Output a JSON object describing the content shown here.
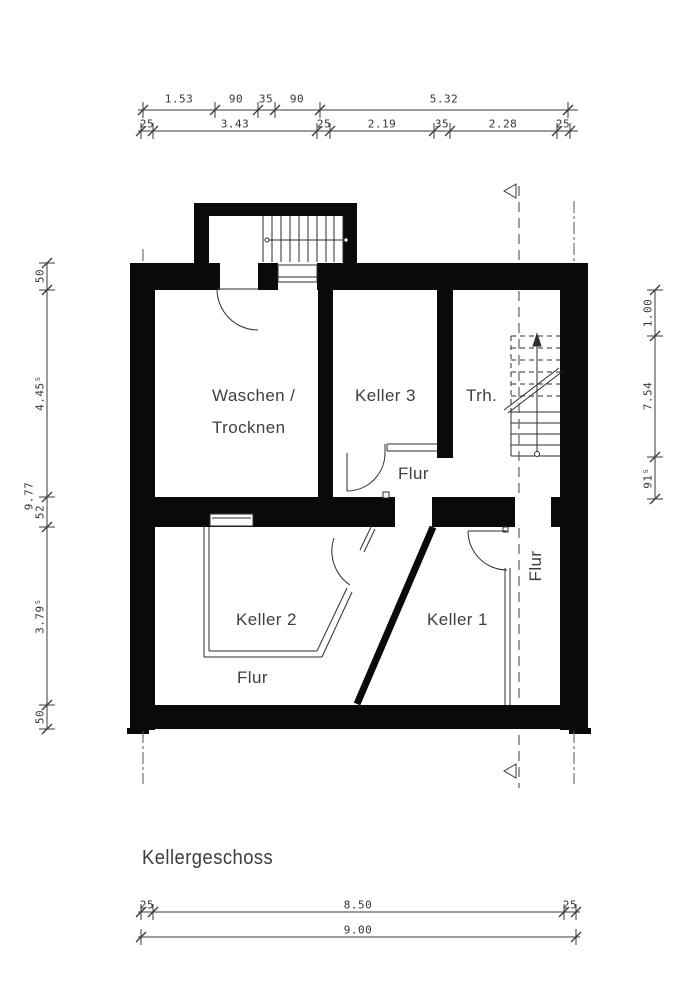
{
  "title": "Kellergeschoss",
  "rooms": {
    "waschen_line1": "Waschen /",
    "waschen_line2": "Trocknen",
    "keller3": "Keller 3",
    "trh": "Trh.",
    "flur_upper": "Flur",
    "keller2": "Keller 2",
    "keller1": "Keller 1",
    "flur_lower": "Flur",
    "flur_right": "Flur"
  },
  "dimensions": {
    "top_upper": [
      "1.53",
      "90",
      "35",
      "90",
      "5.32"
    ],
    "top_lower": [
      "25",
      "3.43",
      "25",
      "2.19",
      "35",
      "2.28",
      "25"
    ],
    "left_segments": [
      "50",
      "4.45⁵",
      "52",
      "3.79⁵",
      "50"
    ],
    "left_total": "9.77",
    "right_segments": [
      "1.00",
      "7.54",
      "91⁵"
    ],
    "bottom_segments": [
      "25",
      "8.50",
      "25"
    ],
    "bottom_total": "9.00"
  },
  "colors": {
    "wall": "#0a0a0a",
    "line": "#2e2e2e",
    "dim_line": "#3a3a3a",
    "dashed_ref": "#5f5f5f",
    "text": "#3f3f3f"
  }
}
